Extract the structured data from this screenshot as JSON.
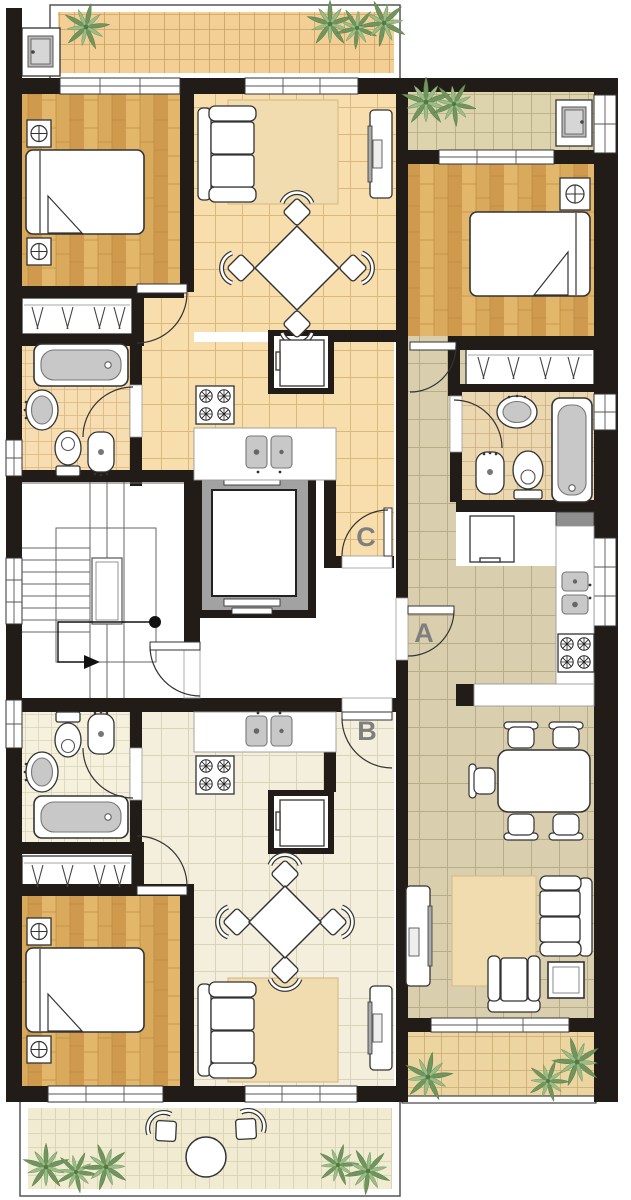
{
  "labels": {
    "apartment_a": "A",
    "apartment_b": "B",
    "apartment_c": "C"
  },
  "palette": {
    "wall": "#211c18",
    "parquet_light": "#e2b66b",
    "parquet_mid": "#d9a95c",
    "parquet_dark": "#cf9a4e",
    "tile_c": "#f8ddad",
    "tile_c_line": "#d9b87b",
    "tile_a": "#d9cfae",
    "tile_a_line": "#b9ad88",
    "tile_b": "#f4efdd",
    "tile_b_line": "#d9d3ba",
    "bath_c": "#f7ddb2",
    "bath_a": "#ecd8b0",
    "bath_b": "#f6f1dc",
    "balcony_c": "#f3cf96",
    "balcony_a_north": "#ddd3ac",
    "balcony_a_south": "#edd5a1",
    "balcony_b": "#f1ebd1",
    "rug": "#f0dcae",
    "fixture_stroke": "#333333",
    "basin_gray": "#c8c8c8",
    "elevator_shaft": "#a2a2a2",
    "plant_dark": "#6f9660",
    "plant_light": "#9cbd87",
    "label_color": "#7f7f7f"
  },
  "floor_plan": {
    "apartments": [
      {
        "id": "A",
        "rooms": [
          "bedroom",
          "bathroom",
          "kitchen",
          "living-dining-room",
          "balcony-north",
          "balcony-south"
        ]
      },
      {
        "id": "B",
        "rooms": [
          "bedroom",
          "bathroom",
          "kitchen",
          "living-dining-room",
          "hall",
          "balcony-south"
        ]
      },
      {
        "id": "C",
        "rooms": [
          "bedroom",
          "bathroom",
          "kitchen",
          "living-dining-room",
          "hall",
          "balcony-north"
        ]
      }
    ],
    "common_areas": [
      "staircase",
      "elevator",
      "landing-corridor"
    ],
    "fixture_icons": [
      "double-bed",
      "nightstand-lamp",
      "wardrobe",
      "sofa",
      "armchair",
      "coffee-table",
      "tv-unit",
      "dining-table",
      "chair",
      "rug",
      "bathtub",
      "washbasin",
      "toilet",
      "bidet",
      "kitchen-sink",
      "stove",
      "refrigerator",
      "kitchen-counter",
      "plant",
      "patio-table",
      "patio-chair",
      "utility-door",
      "stair-direction-arrow"
    ]
  }
}
